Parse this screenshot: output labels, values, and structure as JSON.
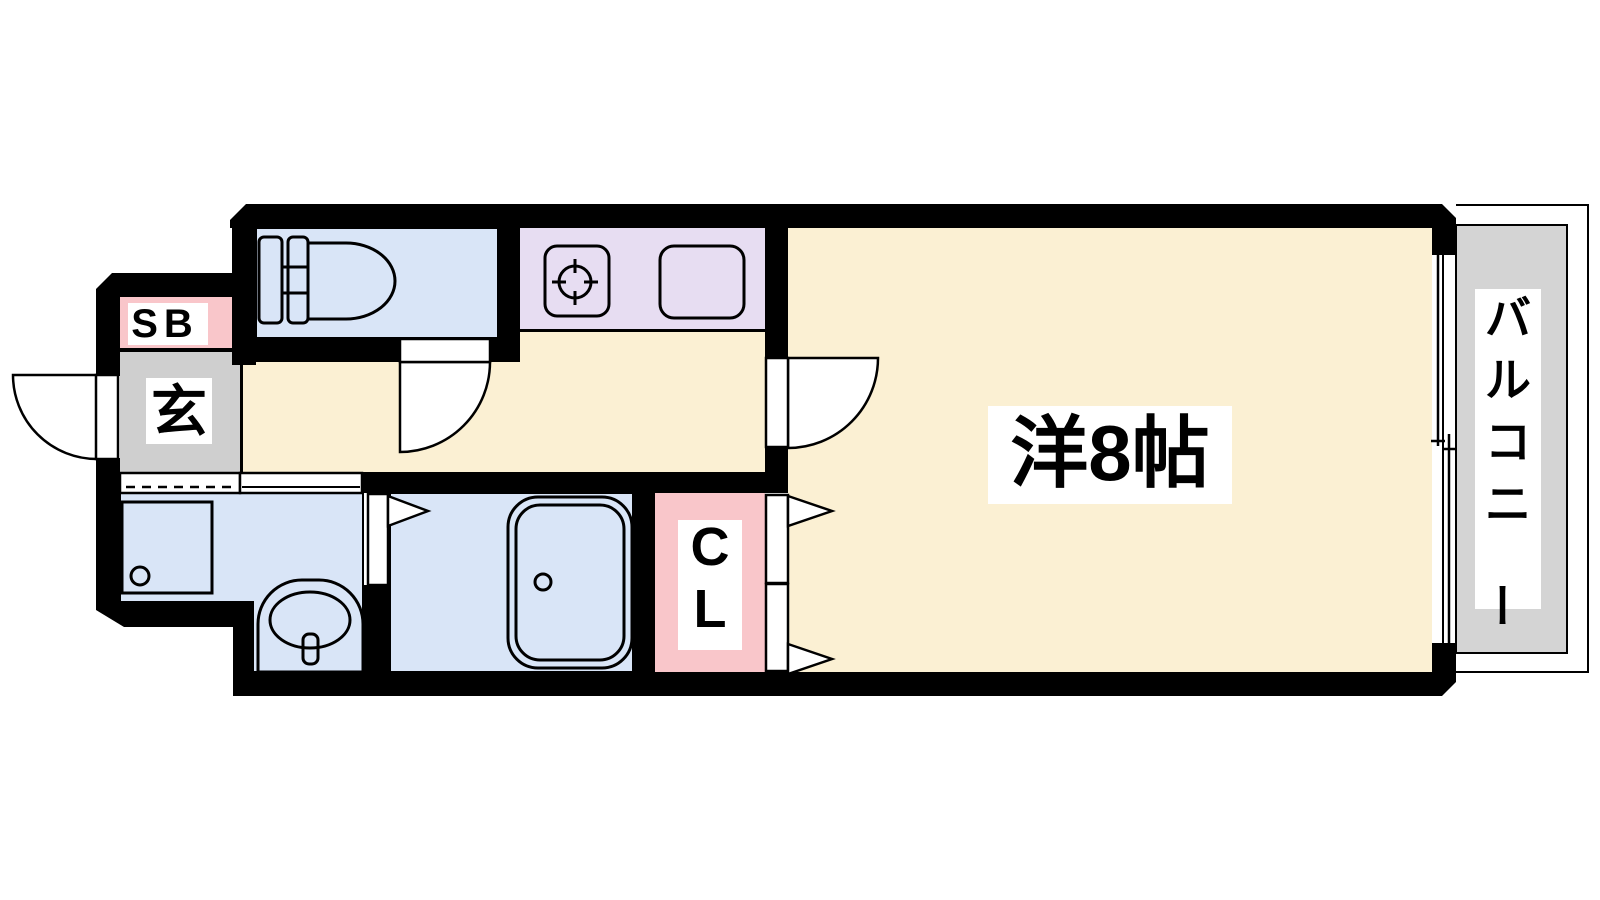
{
  "page": {
    "background": "#FFFFFF"
  },
  "floor_plan": {
    "labels": {
      "shoe_box": "SB",
      "entrance": "玄",
      "closet": "CL",
      "main_room": "洋8帖",
      "balcony": "バルコニー"
    },
    "colors": {
      "wall": "#000000",
      "main_floor": "#FBF0D3",
      "wet_floor": "#D9E5F7",
      "kitchen_counter": "#E7DDF2",
      "storage_pink": "#F9C6CA",
      "entrance_gray": "#CFCFCF",
      "balcony_gray": "#D4D4D4",
      "label_bg": "#FFFFFF"
    },
    "icons": [
      "toilet-icon",
      "stove-burner-icon",
      "kitchen-sink-icon",
      "washing-machine-pan-icon",
      "washbasin-icon",
      "bathtub-icon",
      "door-swing-icon",
      "folding-door-icon",
      "sliding-door-icon",
      "sliding-window-icon"
    ]
  }
}
